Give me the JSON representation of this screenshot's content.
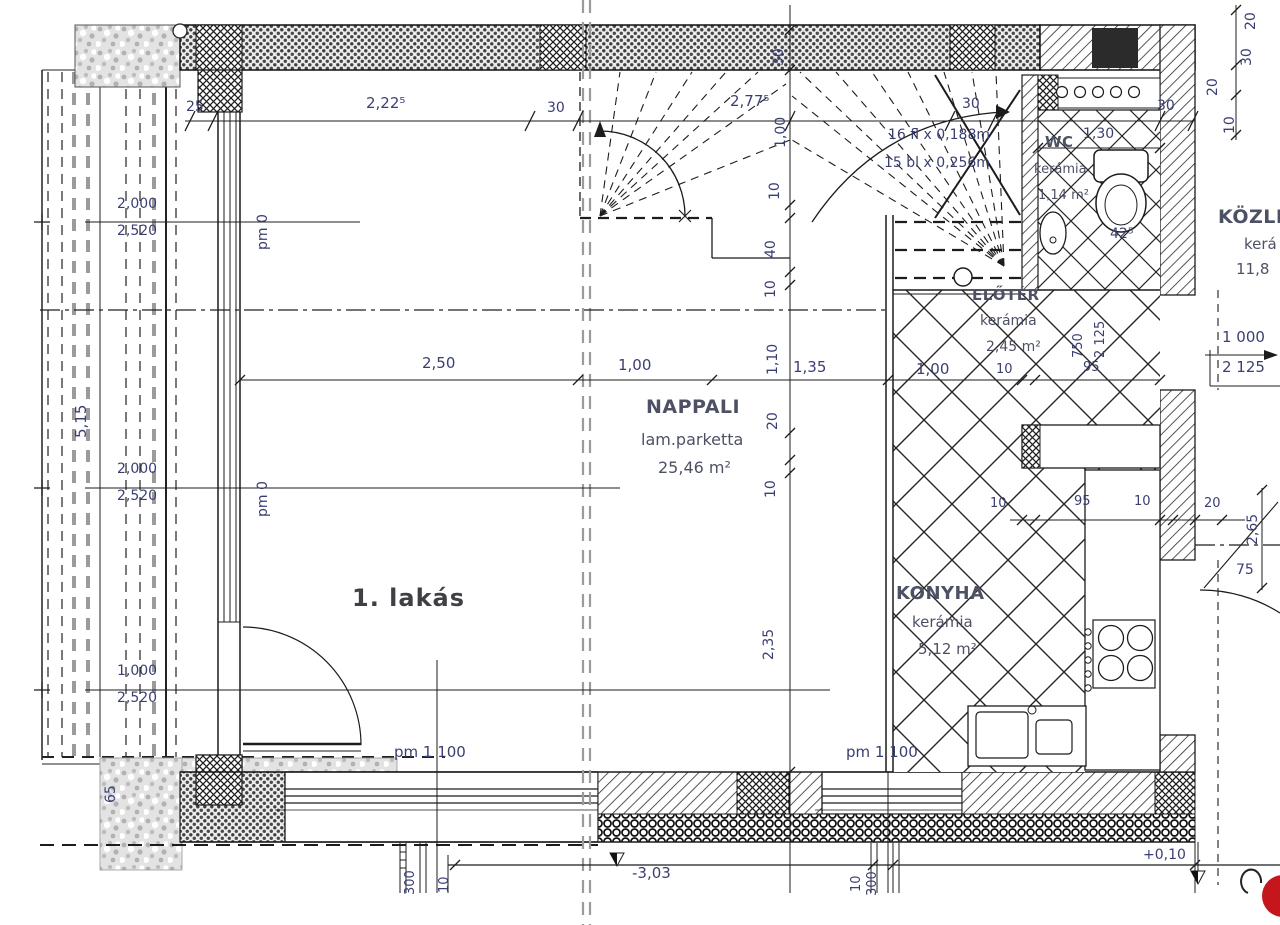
{
  "colors": {
    "line": "#1c1c1c",
    "dim_text": "#3a3f72",
    "room_text": "#4d5164",
    "axis_gray": "#9b9b9b",
    "logo_red": "#c4161c"
  },
  "unit": {
    "label": "1. lakás"
  },
  "rooms": {
    "nappali": {
      "name": "NAPPALI",
      "finish": "lam.parketta",
      "area": "25,46 m²"
    },
    "konyha": {
      "name": "KONYHA",
      "finish": "kerámia",
      "area": "5,12 m²"
    },
    "eloter": {
      "name": "ELŐTÉR",
      "finish": "kerámia",
      "area": "2,45 m²"
    },
    "wc": {
      "name": "WC",
      "finish": "kerámia",
      "area": "1,14 m²"
    },
    "kozlekedo": {
      "name": "KÖZLE",
      "finish": "kerá",
      "area": "11,8"
    }
  },
  "stair": {
    "risers": "16 fl x 0,188m",
    "treads": "15 bl x 0,256m"
  },
  "levels": {
    "pm0": "pm 0",
    "pm1100": "pm 1 100",
    "below": "-3,03",
    "entry": "+0,10"
  },
  "dims": {
    "top": {
      "d25": "25",
      "d2225": "2,22⁵",
      "d30a": "30",
      "d2775": "2,77⁵",
      "d30b": "30",
      "d130": "1,30",
      "d30c": "30"
    },
    "vchain": [
      "30",
      "1,00",
      "10",
      "40",
      "10",
      "1,10",
      "20",
      "10",
      "2,35"
    ],
    "hrow": [
      "2,50",
      "1,00",
      "1,35",
      "1,00",
      "10",
      "95"
    ],
    "krow": [
      "10",
      "95",
      "10",
      "20"
    ],
    "left": {
      "v515": "5,15",
      "p1t": "2,000",
      "p1b": "2,520",
      "p2t": "2,000",
      "p2b": "2,520",
      "p3t": "1,000",
      "p3b": "2,520",
      "v65": "65"
    },
    "right": {
      "w1000": "1 000",
      "h2125": "2 125",
      "v265": "2,65",
      "d75": "75",
      "door_w": "750",
      "door_h": "2 125",
      "wc42": "42⁵",
      "tr": [
        "20",
        "30",
        "20",
        "10"
      ]
    },
    "bottom": {
      "b300l": "300",
      "b10l": "10",
      "b10r": "10",
      "b300r": "300"
    }
  }
}
